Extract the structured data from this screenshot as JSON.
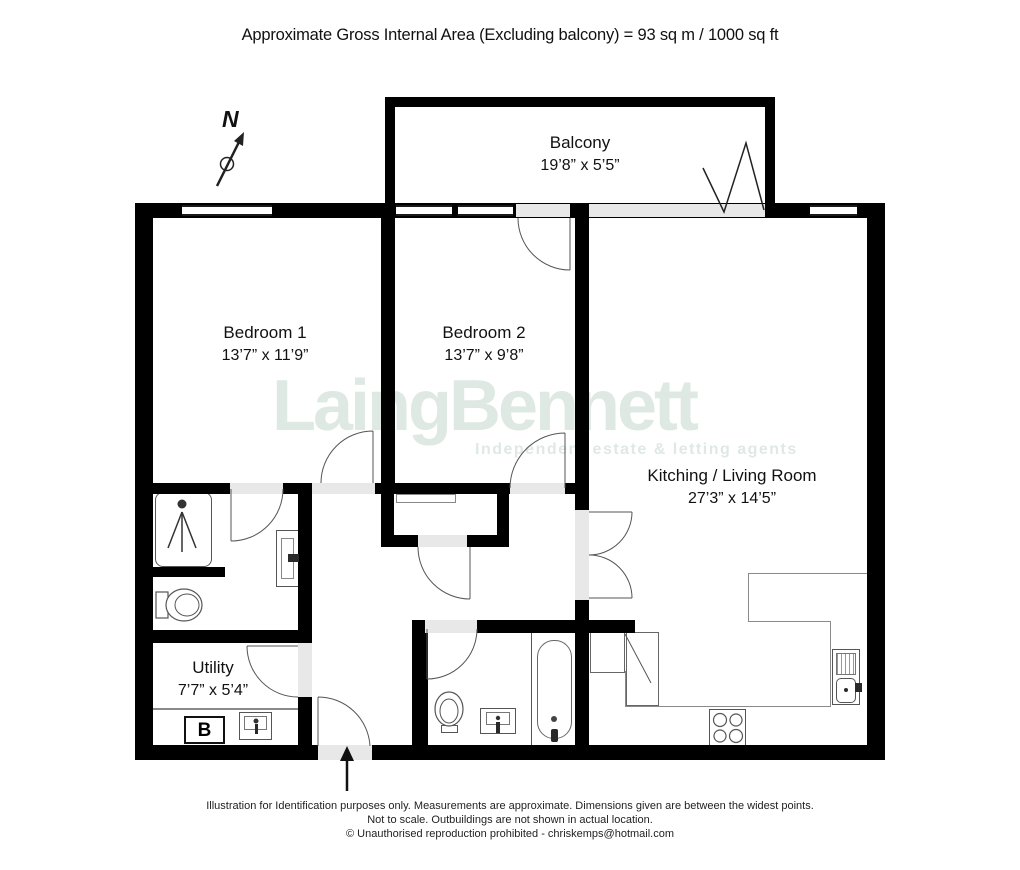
{
  "title": "Approximate Gross Internal Area (Excluding balcony)  = 93 sq m /  1000 sq ft",
  "watermark": {
    "brand": "LaingBennett",
    "tagline": "Independent estate & letting agents"
  },
  "compass": {
    "label": "N"
  },
  "rooms": [
    {
      "id": "balcony",
      "name": "Balcony",
      "dims": "19’8” x 5’5”"
    },
    {
      "id": "bedroom1",
      "name": "Bedroom 1",
      "dims": "13’7” x 11’9”"
    },
    {
      "id": "bedroom2",
      "name": "Bedroom 2",
      "dims": "13’7” x 9’8”"
    },
    {
      "id": "kitchen_living",
      "name": "Kitching / Living Room",
      "dims": "27’3” x 14’5”"
    },
    {
      "id": "utility",
      "name": "Utility",
      "dims": "7’7” x 5’4”"
    }
  ],
  "fixtures": {
    "boiler_label": "B"
  },
  "footer": {
    "line1": "Illustration for Identification purposes only.  Measurements are approximate. Dimensions given are between the widest points.",
    "line2": "Not to scale.  Outbuildings are not shown in actual location.",
    "line3": "© Unauthorised reproduction prohibited  -  chriskemps@hotmail.com"
  },
  "colors": {
    "wall": "#000000",
    "opening": "#e8e8e8",
    "fixture_line": "#555555",
    "watermark": "#dfe9e4",
    "text": "#1a1a1a"
  }
}
